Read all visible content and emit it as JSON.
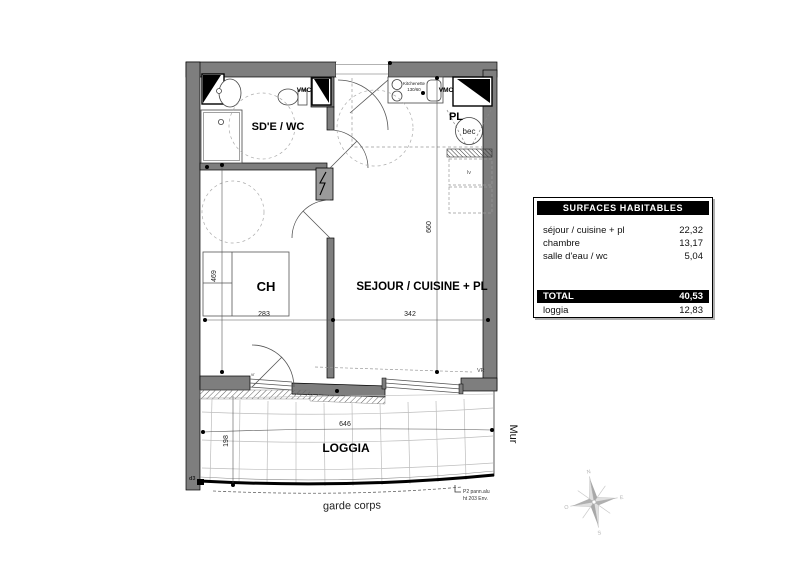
{
  "plan": {
    "rooms": {
      "sdewc": "SD'E / WC",
      "ch": "CH",
      "sejour": "SEJOUR / CUISINE + PL",
      "pl": "PL",
      "bec": "bec",
      "loggia": "LOGGIA"
    },
    "labels": {
      "vmc": "VMC",
      "kitchenette_l1": "Kitchenette",
      "kitchenette_l2": "130/60",
      "lv": "lv",
      "vr": "VR",
      "vr_small": "vr",
      "d3": "d3"
    },
    "dims": {
      "h_sejour": "660",
      "h_ch": "469",
      "w_ch": "283",
      "w_sejour": "342",
      "w_loggia": "646",
      "d_loggia": "198"
    },
    "notes": {
      "mur": "Mur",
      "garde_corps": "garde corps",
      "p2_l1": "P2 pann.alu",
      "p2_l2": "ht 203 Env."
    }
  },
  "table": {
    "title": "SURFACES HABITABLES",
    "rows": [
      {
        "label": "séjour / cuisine  + pl",
        "value": "22,32"
      },
      {
        "label": "chambre",
        "value": "13,17"
      },
      {
        "label": "salle d'eau / wc",
        "value": "5,04"
      }
    ],
    "total": {
      "label": "TOTAL",
      "value": "40,53"
    },
    "extra": {
      "label": "loggia",
      "value": "12,83"
    }
  },
  "compass": {
    "n": "N",
    "e": "E",
    "s": "S",
    "o": "O"
  },
  "colors": {
    "wall": "#7e7e7e",
    "line": "#000000",
    "grid": "#bdbdbd",
    "dash": "#999999"
  }
}
